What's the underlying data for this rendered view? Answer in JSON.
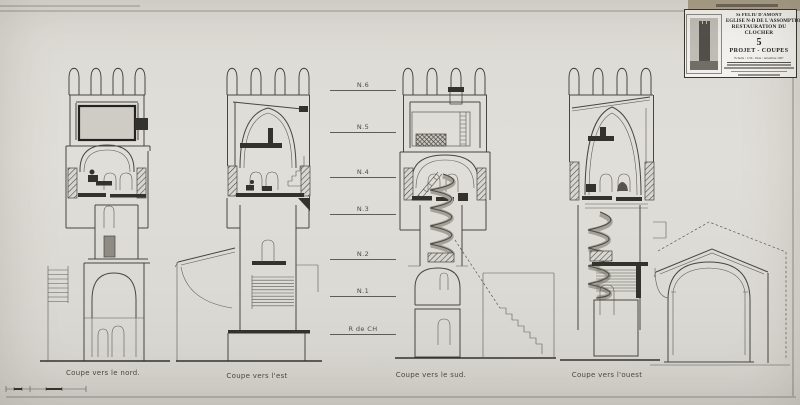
{
  "colors": {
    "paper": "#dfddd7",
    "ink": "#474640",
    "dark_fill": "#33322c",
    "board_tan": "#aba089",
    "title_block_bg": "#f3f2ee"
  },
  "title_block": {
    "commune": "St FELIU D'AMONT",
    "title1": "EGLISE N-D DE L'ASSOMPTION",
    "title2": "RESTAURATION DU CLOCHER",
    "sheet_number": "5",
    "subtitle": "PROJET - COUPES",
    "scale_date": "Echelle : 1/50 - Date : décembre 1987"
  },
  "levels": [
    {
      "label": "N.6",
      "y": 90
    },
    {
      "label": "N.5",
      "y": 132
    },
    {
      "label": "N.4",
      "y": 177
    },
    {
      "label": "N.3",
      "y": 214
    },
    {
      "label": "N.2",
      "y": 259
    },
    {
      "label": "N.1",
      "y": 296
    },
    {
      "label": "R de CH",
      "y": 334
    }
  ],
  "captions": [
    {
      "label": "Coupe vers le nord.",
      "x": 103,
      "y": 369
    },
    {
      "label": "Coupe vers l'est",
      "x": 257,
      "y": 372
    },
    {
      "label": "Coupe vers le sud.",
      "x": 431,
      "y": 371
    },
    {
      "label": "Coupe vers l'ouest",
      "x": 607,
      "y": 371
    }
  ]
}
